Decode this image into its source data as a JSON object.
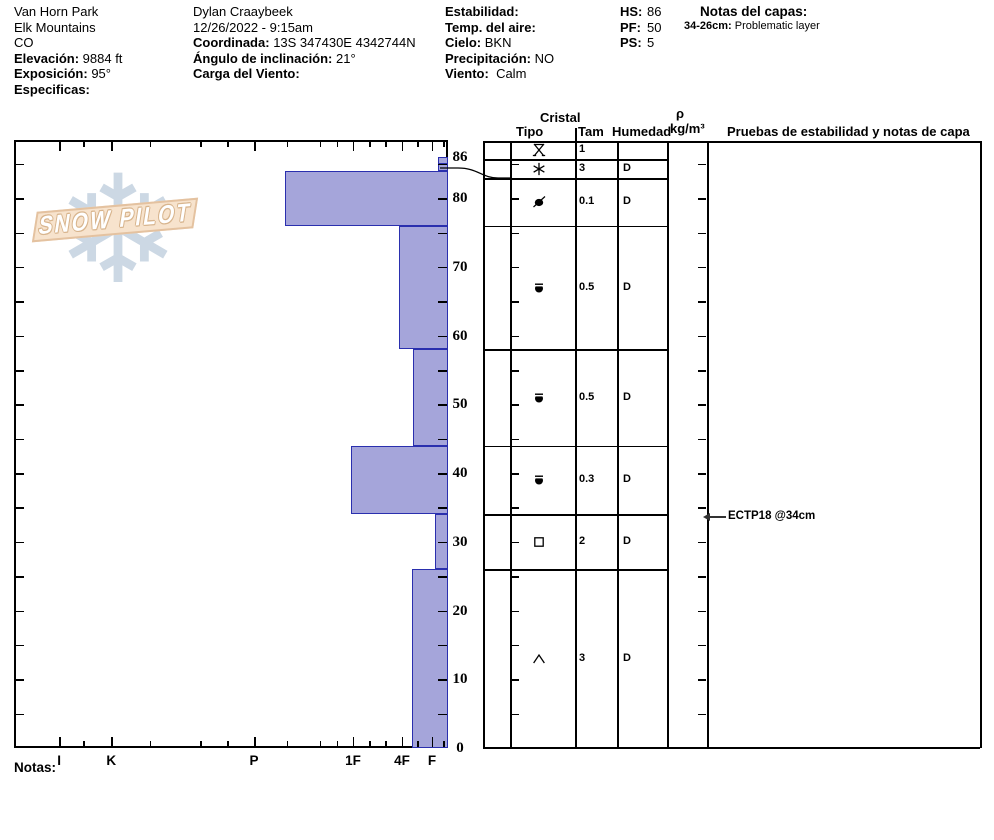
{
  "header": {
    "site": {
      "name": "Van Horn Park",
      "range": "Elk Mountains",
      "state": "CO",
      "elevation_label": "Elevación:",
      "elevation_value": "9884 ft",
      "aspect_label": "Exposición:",
      "aspect_value": "95°",
      "specifics_label": "Especificas:",
      "specifics_value": ""
    },
    "observer": {
      "name": "Dylan Craaybeek",
      "datetime": "12/26/2022 - 9:15am",
      "coordinate_label": "Coordinada:",
      "coordinate_value": "13S 347430E 4342744N",
      "slope_angle_label": "Ángulo de inclinación:",
      "slope_angle_value": "21°",
      "wind_loading_label": "Carga del Viento:",
      "wind_loading_value": ""
    },
    "weather": {
      "stability_label": "Estabilidad:",
      "stability_value": "",
      "air_temp_label": "Temp. del aire:",
      "air_temp_value": "",
      "sky_label": "Cielo:",
      "sky_value": "BKN",
      "precip_label": "Precipitación:",
      "precip_value": "NO",
      "wind_label": "Viento:",
      "wind_value": "Calm"
    },
    "totals": {
      "hs_label": "HS:",
      "hs_value": "86",
      "pf_label": "PF:",
      "pf_value": "50",
      "ps_label": "PS:",
      "ps_value": "5"
    },
    "layer_notes": {
      "title": "Notas del capas:",
      "note_range": "34-26cm:",
      "note_text": "Problematic layer"
    }
  },
  "logo": {
    "text": "SNOW PILOT",
    "snowflake_icon": "❄"
  },
  "table_headers": {
    "cristal": "Cristal",
    "tipo": "Tipo",
    "tam": "Tam",
    "humedad": "Humedad",
    "rho": "ρ",
    "rho_units": "kg/m³",
    "pruebas": "Pruebas de estabilidad y notas de capa"
  },
  "annotation": {
    "text": "ECTP18 @34cm",
    "depth_cm": 34
  },
  "notes_label": "Notas:",
  "chart_data": {
    "type": "bar",
    "title": "Snow pit profile: hand hardness vs depth",
    "depth_axis": {
      "unit": "cm",
      "max": 86,
      "labeled_ticks": [
        86,
        80,
        70,
        60,
        50,
        40,
        30,
        20,
        10,
        0
      ],
      "minor_tick_every_cm": 5
    },
    "hardness_axis": {
      "labels": [
        "I",
        "K",
        "P",
        "1F",
        "4F",
        "F"
      ],
      "label_fracs": [
        0.104,
        0.224,
        0.553,
        0.781,
        0.894,
        0.963
      ],
      "minor_fracs": [
        0.159,
        0.313,
        0.429,
        0.491,
        0.629,
        0.705,
        0.744,
        0.818,
        0.855,
        0.929,
        0.989
      ]
    },
    "bar_fill": "#a5a5da",
    "bar_border": "#2a2fae",
    "layers": [
      {
        "top_cm": 86,
        "bottom_cm": 85,
        "grain_type": "SH",
        "grain_symbol": "surface-hoar",
        "size_mm": "1",
        "moisture": "",
        "hardness": "F-",
        "bar_frac": 0.977
      },
      {
        "top_cm": 85,
        "bottom_cm": 84,
        "grain_type": "PP",
        "grain_symbol": "stellar",
        "size_mm": "3",
        "moisture": "D",
        "hardness": "F-",
        "bar_frac": 0.977
      },
      {
        "top_cm": 84,
        "bottom_cm": 76,
        "grain_type": "MFcr",
        "grain_symbol": "crust",
        "size_mm": "0.1",
        "moisture": "D",
        "hardness": "P-",
        "bar_frac": 0.624
      },
      {
        "top_cm": 76,
        "bottom_cm": 58,
        "grain_type": "RG",
        "grain_symbol": "rounds",
        "size_mm": "0.5",
        "moisture": "D",
        "hardness": "4F",
        "bar_frac": 0.887
      },
      {
        "top_cm": 58,
        "bottom_cm": 44,
        "grain_type": "RG",
        "grain_symbol": "rounds",
        "size_mm": "0.5",
        "moisture": "D",
        "hardness": "4F+",
        "bar_frac": 0.919
      },
      {
        "top_cm": 44,
        "bottom_cm": 34,
        "grain_type": "RG",
        "grain_symbol": "rounds",
        "size_mm": "0.3",
        "moisture": "D",
        "hardness": "1F",
        "bar_frac": 0.776
      },
      {
        "top_cm": 34,
        "bottom_cm": 26,
        "grain_type": "FC",
        "grain_symbol": "facets",
        "size_mm": "2",
        "moisture": "D",
        "hardness": "F",
        "bar_frac": 0.97
      },
      {
        "top_cm": 26,
        "bottom_cm": 0,
        "grain_type": "DH",
        "grain_symbol": "depth-hoar",
        "size_mm": "3",
        "moisture": "D",
        "hardness": "4F+",
        "bar_frac": 0.917
      }
    ]
  }
}
